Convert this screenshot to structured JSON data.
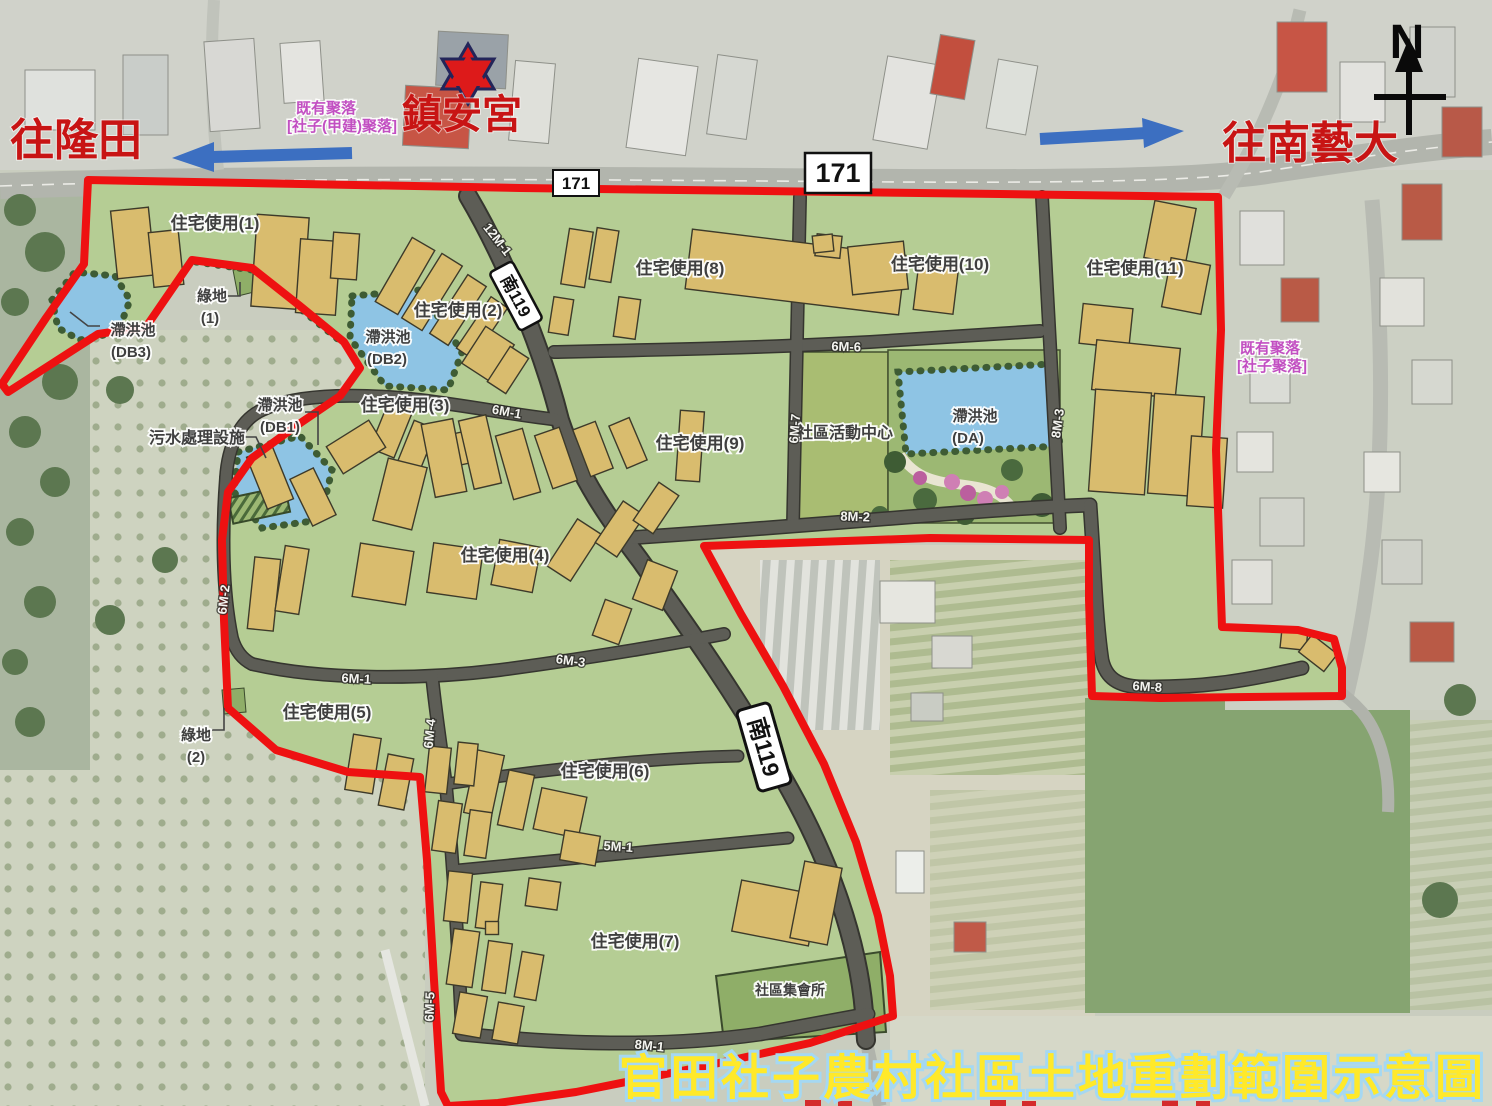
{
  "map_title": "官田社子農村社區土地重劃範圍示意圖",
  "compass_label": "N",
  "landmark_star_label": "鎮安宮",
  "direction_labels": {
    "west": "往隆田",
    "east": "往南藝大"
  },
  "route_shields": {
    "provincial_171": "171",
    "county_119": "南119"
  },
  "settlement_labels": {
    "jiajian": {
      "line1": "既有聚落",
      "line2": "[社子(甲建)聚落]"
    },
    "shezi": {
      "line1": "既有聚落",
      "line2": "[社子聚落]"
    }
  },
  "zone_labels": {
    "r1": "住宅使用(1)",
    "r2": "住宅使用(2)",
    "r3": "住宅使用(3)",
    "r4": "住宅使用(4)",
    "r5": "住宅使用(5)",
    "r6": "住宅使用(6)",
    "r7": "住宅使用(7)",
    "r8": "住宅使用(8)",
    "r9": "住宅使用(9)",
    "r10": "住宅使用(10)",
    "r11": "住宅使用(11)",
    "green1_line1": "綠地",
    "green1_line2": "(1)",
    "green2_line1": "綠地",
    "green2_line2": "(2)",
    "db1_line1": "滯洪池",
    "db1_line2": "(DB1)",
    "db2_line1": "滯洪池",
    "db2_line2": "(DB2)",
    "db3_line1": "滯洪池",
    "db3_line2": "(DB3)",
    "da_line1": "滯洪池",
    "da_line2": "(DA)",
    "sewage": "污水處理設施",
    "community_center": "社區活動中心",
    "assembly_hall": "社區集會所"
  },
  "road_labels": {
    "m12_1": "12M-1",
    "m6_1": "6M-1",
    "m6_2": "6M-2",
    "m6_3": "6M-3",
    "m6_4": "6M-4",
    "m6_5": "6M-5",
    "m6_6": "6M-6",
    "m6_7": "6M-7",
    "m6_8": "6M-8",
    "m8_1": "8M-1",
    "m8_2": "8M-2",
    "m8_3": "8M-3",
    "m5_1": "5M-1"
  },
  "colors": {
    "boundary": "#ee1111",
    "title_fill": "#ffe92a",
    "title_halo": "#a5d8f2",
    "direction_text": "#c81414",
    "settlement_text": "#c24fc2",
    "arrow_blue": "#3c6fc1",
    "plan_green": "#b5cd94",
    "pond_blue": "#8ec4e4",
    "building_tan": "#d9bc6e",
    "road_gray": "#5d5d56"
  }
}
